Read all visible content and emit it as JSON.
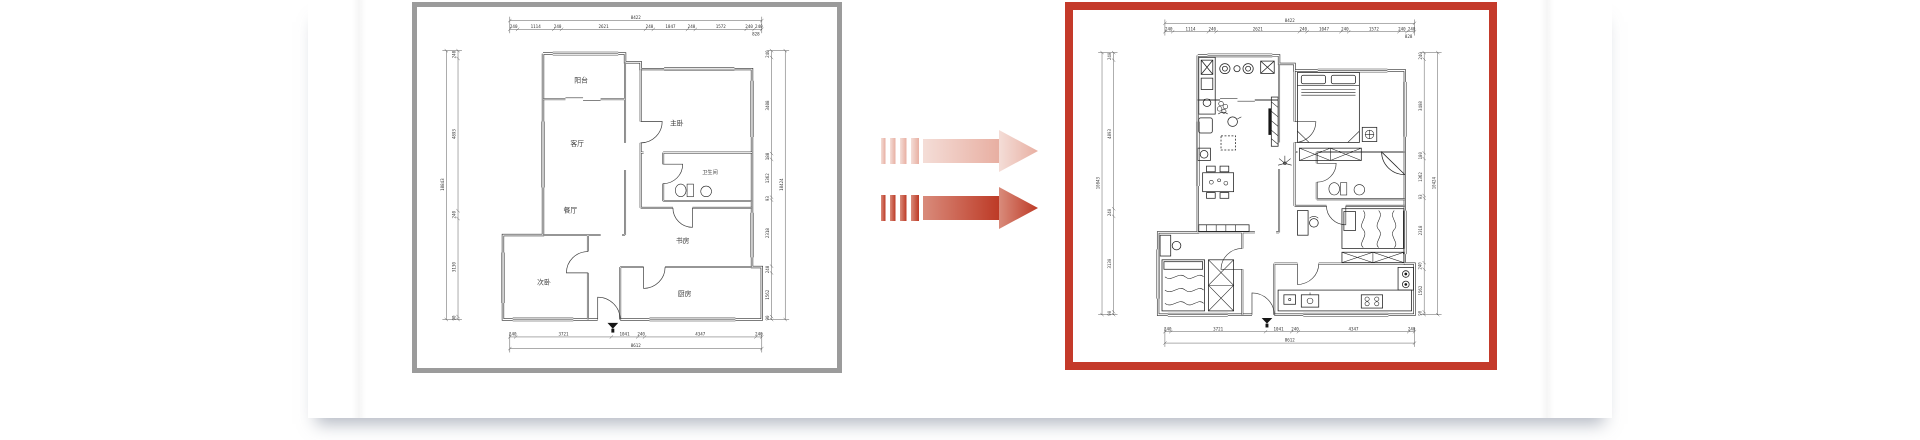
{
  "page": {
    "background": "#ffffff",
    "card_background": "#ffffff"
  },
  "colors": {
    "panel_border_gray": "#9b9b9b",
    "panel_border_red": "#c43a2a",
    "wall_ink": "#2e2e2e",
    "dim_ink": "#555555",
    "arrow_dark_from": "#d98b7b",
    "arrow_dark_to": "#bd3a26",
    "arrow_light_from": "#f4ddd7",
    "arrow_light_to": "#e8afa2"
  },
  "panels": {
    "before": {
      "name": "original unfurnished floor plan",
      "border_color": "#9b9b9b"
    },
    "after": {
      "name": "furnished design floor plan",
      "border_color": "#c43a2a"
    }
  },
  "arrows": {
    "count": 2,
    "direction": "right",
    "style": "dashed tail with gradient"
  },
  "floorplan": {
    "rooms": [
      {
        "label": "阳台"
      },
      {
        "label": "客厅"
      },
      {
        "label": "餐厅"
      },
      {
        "label": "主卧"
      },
      {
        "label": "卫生间"
      },
      {
        "label": "书房"
      },
      {
        "label": "次卧"
      },
      {
        "label": "厨房"
      }
    ],
    "dims": {
      "top": {
        "total": "8422",
        "sub": "828",
        "segments": [
          "240",
          "1114",
          "240",
          "2621",
          "240",
          "1047",
          "240",
          "1572",
          "240",
          "240"
        ]
      },
      "bottom": {
        "total": "8612",
        "segments": [
          "240",
          "3721",
          "1041",
          "240",
          "4347",
          "240"
        ]
      },
      "left": {
        "total": "10843",
        "segments": [
          "240",
          "4893",
          "240",
          "3130",
          "90"
        ]
      },
      "right": {
        "total": "10424",
        "segments": [
          "240",
          "3408",
          "180",
          "1362",
          "93",
          "2318",
          "240",
          "1562",
          "90"
        ]
      }
    }
  }
}
